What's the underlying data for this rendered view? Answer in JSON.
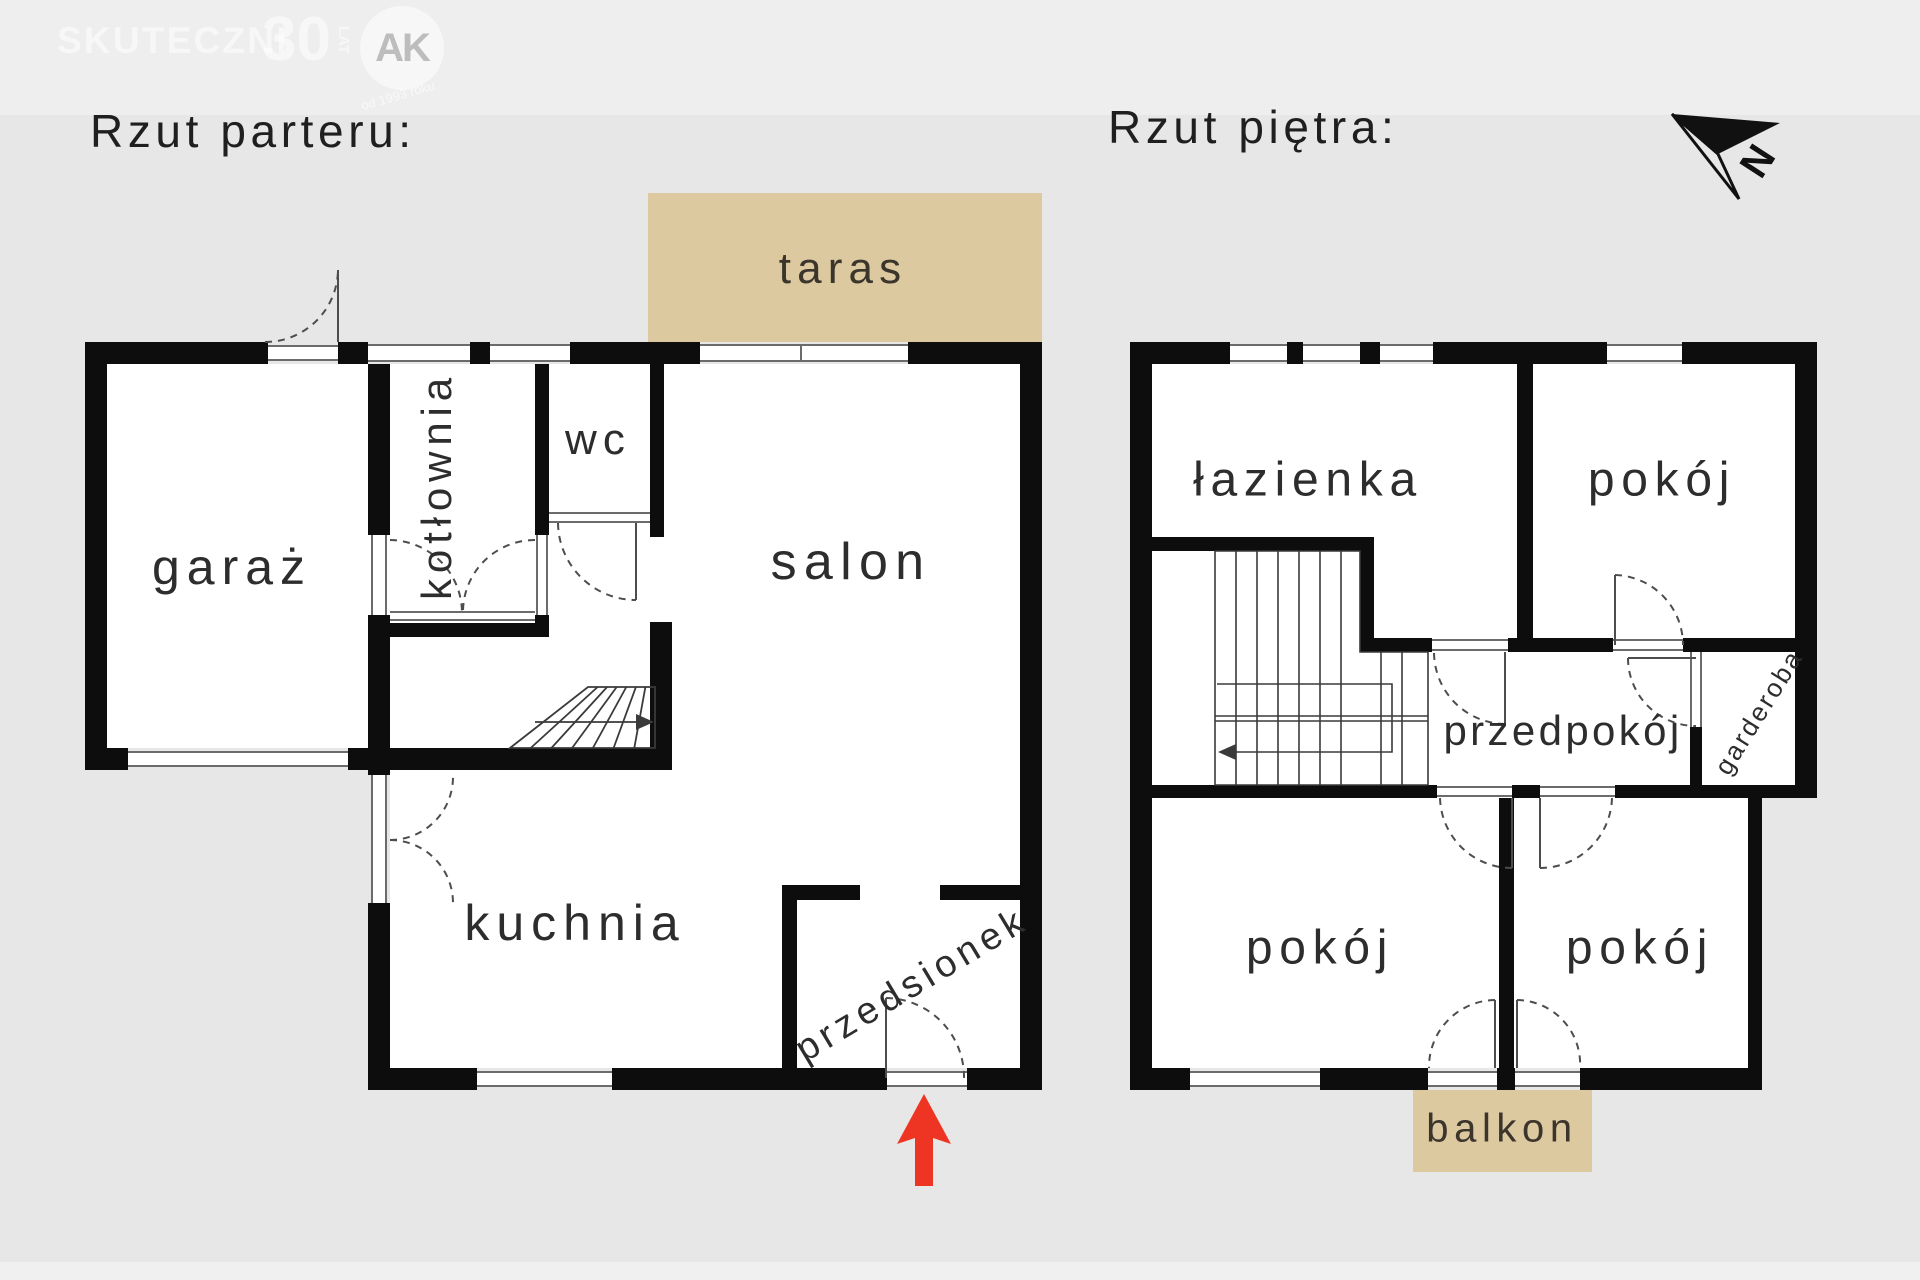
{
  "watermark": {
    "brand": "SKUTECZNI",
    "big_number": "30",
    "small_word": "LAT",
    "badge_monogram": "AK",
    "tagline": "od 1993 roku"
  },
  "headings": {
    "ground_floor": "Rzut parteru:",
    "upper_floor": "Rzut piętra:"
  },
  "compass": {
    "north_label": "N"
  },
  "colors": {
    "background": "#e7e7e7",
    "wall": "#0d0d0d",
    "outdoor_fill": "#dcc9a0",
    "entrance_arrow_red": "#ee3524",
    "line_gray": "#4d4d4d",
    "label_text": "#2d2d2d"
  },
  "ground_floor": {
    "rooms": {
      "garaz": "garaż",
      "kotlownia": "kotłownia",
      "wc": "wc",
      "salon": "salon",
      "kuchnia": "kuchnia",
      "przedsionek": "przedsionek"
    },
    "outdoor": {
      "taras": "taras"
    }
  },
  "upper_floor": {
    "rooms": {
      "lazienka": "łazienka",
      "pokoj_top": "pokój",
      "przedpokoj": "przedpokój",
      "garderoba": "garderoba",
      "pokoj_bottom_left": "pokój",
      "pokoj_bottom_right": "pokój"
    },
    "outdoor": {
      "balkon": "balkon"
    }
  }
}
